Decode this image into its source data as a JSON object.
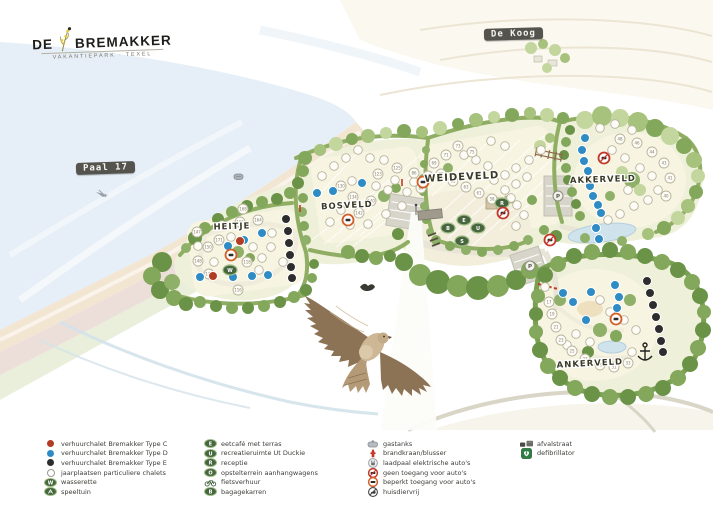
{
  "logo": {
    "word1": "DE",
    "word2": "BREMAKKER",
    "subtitle": "VAKANTIEPARK · TEXEL"
  },
  "signs": {
    "de_koog": "De Koog",
    "paal_17": "Paal 17"
  },
  "map": {
    "area_labels": {
      "heitje": "HEITJE",
      "bosveld": "BOSVELD",
      "weideveld": "WEIDEVELD",
      "akkerveld": "AKKERVELD",
      "ankerveld": "ANKERVELD"
    },
    "facility_badges": {
      "eetcafe": "E",
      "bagagekarren": "B",
      "ut_duckie": "U",
      "receptie": "R",
      "wasserette": "W",
      "speeltuin": "S",
      "opstelterrein": "O",
      "parking": "P"
    },
    "plot_numbers": {
      "heitje": [
        "147",
        "166",
        "164",
        "150",
        "148",
        "168",
        "118",
        "116",
        "171",
        "172"
      ],
      "bosveld": [
        "123",
        "125",
        "130",
        "134",
        "140",
        "142"
      ],
      "weideveld": [
        "73",
        "75",
        "71",
        "69",
        "67",
        "65",
        "63",
        "61",
        "58",
        "86",
        "87",
        "84"
      ],
      "akkerveld": [
        "48",
        "46",
        "44",
        "43",
        "41",
        "40"
      ],
      "ankerveld": [
        "17",
        "19",
        "21",
        "23",
        "25",
        "27",
        "29",
        "31",
        "33"
      ]
    },
    "colors": {
      "type_c": "#b23b23",
      "type_d": "#2e8bc4",
      "type_e": "#2d2d2d",
      "facility_green": "#47663f",
      "sea": "#e6eff7",
      "sand": "#f2e6d2",
      "field": "#f8f4e2",
      "hedge": "#8fae63"
    }
  },
  "legend": {
    "columns": [
      {
        "items": [
          {
            "label": "verhuurchalet Bremakker Type C"
          },
          {
            "label": "verhuurchalet Bremakker Type D"
          },
          {
            "label": "verhuurchalet Bremakker Type E"
          },
          {
            "label": "jaarplaatsen particuliere chalets"
          },
          {
            "label": "wasserette"
          },
          {
            "label": "speeltuin"
          }
        ]
      },
      {
        "items": [
          {
            "label": "eetcafé met terras"
          },
          {
            "label": "recreatieruimte Ut Duckie"
          },
          {
            "label": "receptie"
          },
          {
            "label": "opstelterrein aanhangwagens"
          },
          {
            "label": "fietsverhuur"
          },
          {
            "label": "bagagekarren"
          }
        ]
      },
      {
        "items": [
          {
            "label": "gastanks"
          },
          {
            "label": "brandkraan/blusser"
          },
          {
            "label": "laadpaal elektrische auto's"
          },
          {
            "label": "geen toegang voor auto's"
          },
          {
            "label": "beperkt toegang voor auto's"
          },
          {
            "label": "huisdiervrij"
          }
        ]
      },
      {
        "items": [
          {
            "label": "afvalstraat"
          },
          {
            "label": "defibrillator"
          }
        ]
      }
    ]
  }
}
